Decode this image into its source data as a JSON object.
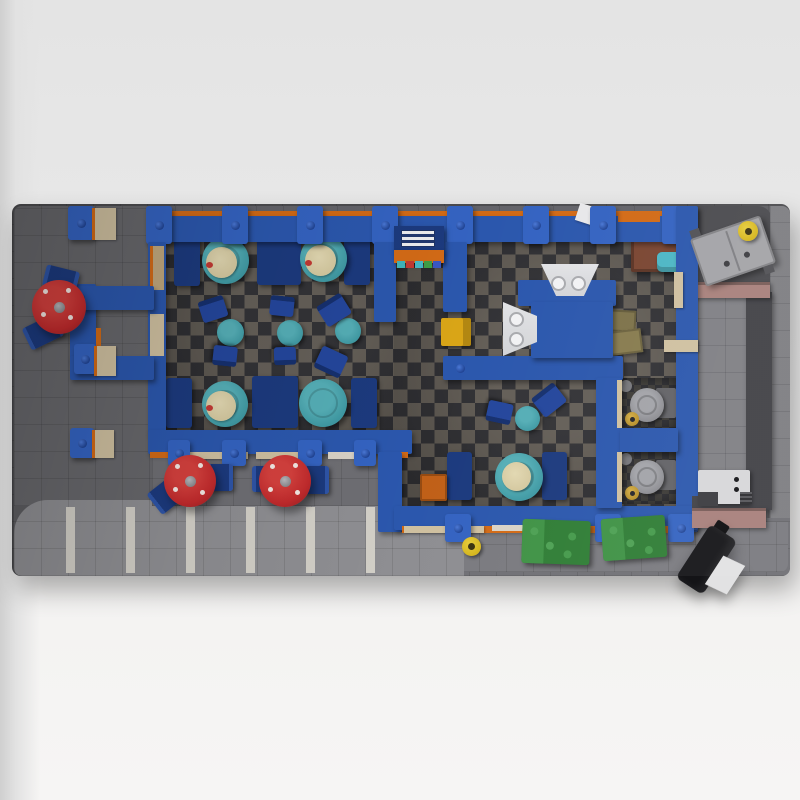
{
  "scene": {
    "title": "Top-down 3D render of a LEGO diner model on a dark gray baseplate",
    "labels": {
      "baseplate": "Dark gray baseplate with tile grid",
      "building": "Blue-walled diner building with checkered floor",
      "dining_room": "Dining room with booths and cafe tables",
      "entrance": "Left entrance vestibule with outdoor stool table",
      "back_room": "Back room with serving counter and sinks",
      "restroom": "Restroom with two toilet stalls and sink island",
      "patio": "Outdoor patio with red umbrella tables",
      "parking": "Parking lot with white stall stripes",
      "alley": "Back alley with green dumpsters",
      "loading_dock": "Right-side walkway between mauve walls"
    }
  },
  "inventory": {
    "booth_round_tables": 5,
    "cafe_tables": 4,
    "cafe_chairs": 8,
    "outdoor_umbrella_tables": 3,
    "outdoor_benches": 6,
    "toilet_stalls": 2,
    "sink_units": 2,
    "green_dumpsters": 2,
    "gray_dumpsters": 1,
    "fire_hydrants": 2,
    "parking_stripes": 6,
    "ice_machine": 1,
    "black_hand_cart": 1
  },
  "palette": {
    "plate": "#5d5d61",
    "plate_left": "#67676b",
    "plate_topband": "#636369",
    "plate_ne_dark": "#4a4a4e",
    "plate_right": "#7e7e82",
    "walkway": "#7f7f84",
    "slab_dark": "#414146",
    "mauve": "#a8807b",
    "alley": "#707075",
    "alley_light": "#7a7a7f",
    "parking": "#8e8e92",
    "stripe": "#d2cfc7",
    "patio": "#6e6e73",
    "checker_light": "#6d675f",
    "checker_dark": "#37373b",
    "stall_dark": "#2e2e32",
    "stall_mid": "#403e3a",
    "wall_blue": "#2b57ad",
    "pillar_blue": "#3463c1",
    "stud_blue": "#1e4190",
    "orange": "#d26a16",
    "sill_tan": "#cfc0a0",
    "door_tan": "#c1a87e",
    "sill_white": "#d9d2c6",
    "bench_navy": "#1c3a7e",
    "chair_navy": "#24469c",
    "chair_back": "#16306e",
    "table_teal": "#3f99a3",
    "table_teal_hi": "#55aeb6",
    "plate_cream": "#d5c9a0",
    "red": "#c12a2c",
    "red_hi": "#d4403d",
    "green": "#2f7d35",
    "green_hi": "#3f9245",
    "gray_dumpster": "#a3a3a7",
    "yellow": "#d4b51c",
    "yellow_box": "#d9a517",
    "orange_crate": "#c06018",
    "sink_gray": "#d3d4d7",
    "toilet_gray": "#8a8a8f",
    "tank_gray": "#626266",
    "gold": "#b8912a",
    "brown": "#7a4531",
    "cyan_bin": "#4cb6c4",
    "olive": "#7d7249",
    "ice_white": "#d7d7d9",
    "black": "#141417",
    "white_door": "#e8e8ea"
  }
}
